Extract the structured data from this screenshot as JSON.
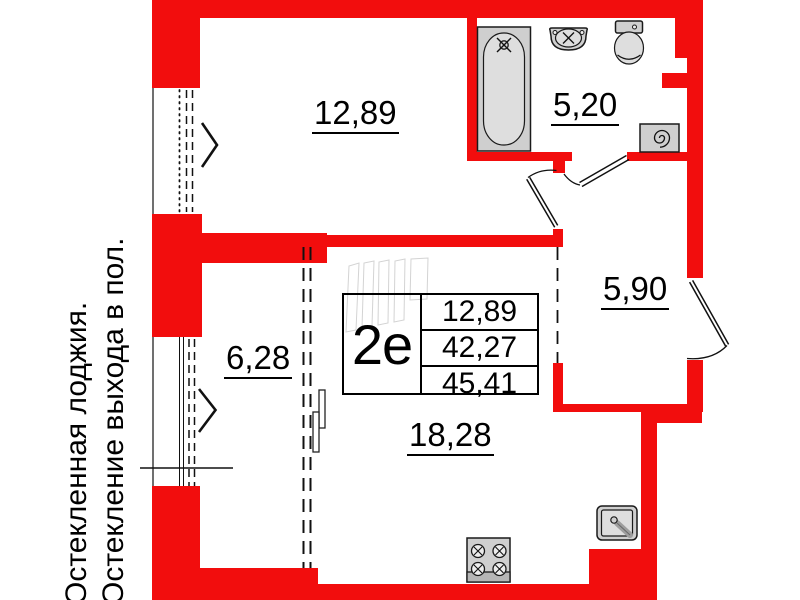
{
  "plan": {
    "unit": {
      "label": "2е"
    },
    "info_table": {
      "values": [
        "12,89",
        "42,27",
        "45,41"
      ]
    },
    "rooms": [
      {
        "id": "bedroom",
        "area": "12,89"
      },
      {
        "id": "bathroom",
        "area": "5,20"
      },
      {
        "id": "hallway",
        "area": "5,90"
      },
      {
        "id": "loggia",
        "area": "6,28"
      },
      {
        "id": "kitchen-living",
        "area": "18,28"
      }
    ],
    "note_lines": [
      "Остекленная лоджия.",
      "Остекление выхода в пол."
    ],
    "colors": {
      "wall_red": "#f20d0d",
      "fixture_fill": "#cfcfcf",
      "fixture_stroke": "#1a1a1a",
      "line_black": "#111111"
    },
    "icons": [
      "bathtub-icon",
      "bath-sink-icon",
      "toilet-icon",
      "washing-machine-icon",
      "stove-icon",
      "kitchen-sink-icon",
      "window-chevron-icon",
      "door-swing-icon"
    ]
  }
}
